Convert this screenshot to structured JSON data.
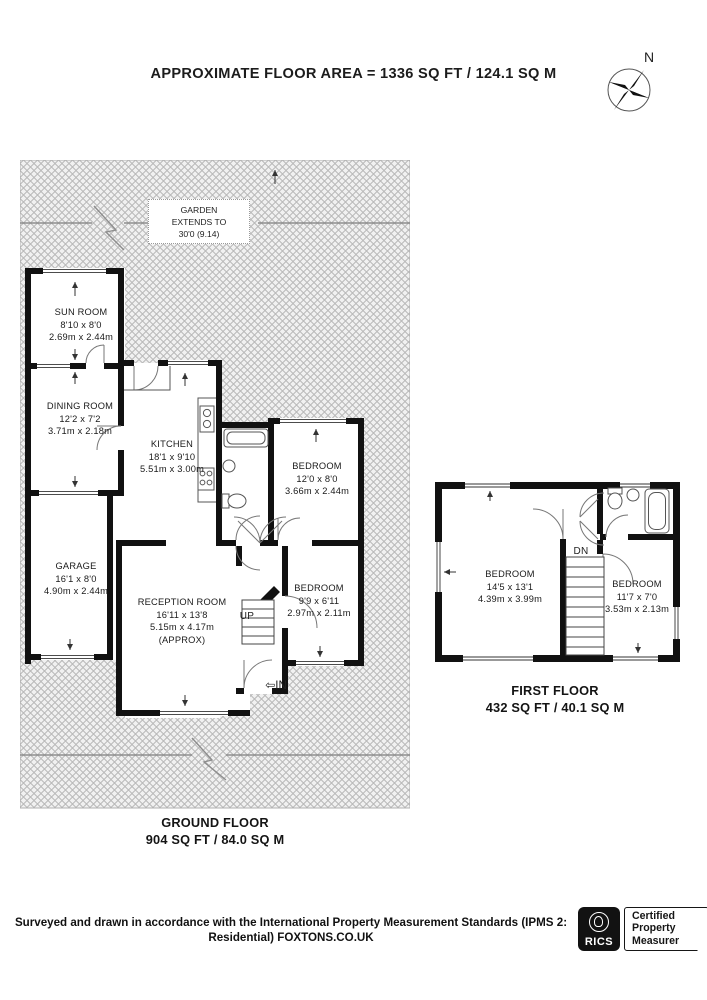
{
  "title": "APPROXIMATE FLOOR AREA = 1336 SQ FT / 124.1 SQ M",
  "compass": {
    "label": "N"
  },
  "garden": {
    "line1": "GARDEN",
    "line2": "EXTENDS TO",
    "line3": "30'0 (9.14)"
  },
  "ground": {
    "rooms": [
      {
        "name": "SUN ROOM",
        "dims_ft": "8'10 x 8'0",
        "dims_m": "2.69m x 2.44m"
      },
      {
        "name": "DINING ROOM",
        "dims_ft": "12'2 x 7'2",
        "dims_m": "3.71m x 2.18m"
      },
      {
        "name": "KITCHEN",
        "dims_ft": "18'1 x 9'10",
        "dims_m": "5.51m x 3.00m"
      },
      {
        "name": "BEDROOM",
        "dims_ft": "12'0 x 8'0",
        "dims_m": "3.66m x 2.44m"
      },
      {
        "name": "GARAGE",
        "dims_ft": "16'1 x 8'0",
        "dims_m": "4.90m x 2.44m"
      },
      {
        "name": "RECEPTION ROOM",
        "dims_ft": "16'11 x 13'8",
        "dims_m": "5.15m x 4.17m",
        "extra": "(APPROX)"
      },
      {
        "name": "BEDROOM",
        "dims_ft": "9'9 x 6'11",
        "dims_m": "2.97m x 2.11m"
      }
    ],
    "stairs_label": "UP",
    "entrance_arrow": "⇦",
    "entrance_label": "IN",
    "caption": "GROUND FLOOR",
    "caption_area": "904 SQ FT / 84.0 SQ M"
  },
  "first": {
    "rooms": [
      {
        "name": "BEDROOM",
        "dims_ft": "14'5 x 13'1",
        "dims_m": "4.39m x 3.99m"
      },
      {
        "name": "BEDROOM",
        "dims_ft": "11'7 x 7'0",
        "dims_m": "3.53m x 2.13m"
      }
    ],
    "stairs_label": "DN",
    "caption": "FIRST FLOOR",
    "caption_area": "432 SQ FT / 40.1 SQ M"
  },
  "footer": {
    "disclaimer_line1": "Surveyed and drawn in accordance with the International Property Measurement Standards (IPMS 2:",
    "disclaimer_line2": "Residential) FOXTONS.CO.UK",
    "rics_brand": "RICS",
    "cert_line1": "Certified",
    "cert_line2": "Property",
    "cert_line3": "Measurer"
  }
}
